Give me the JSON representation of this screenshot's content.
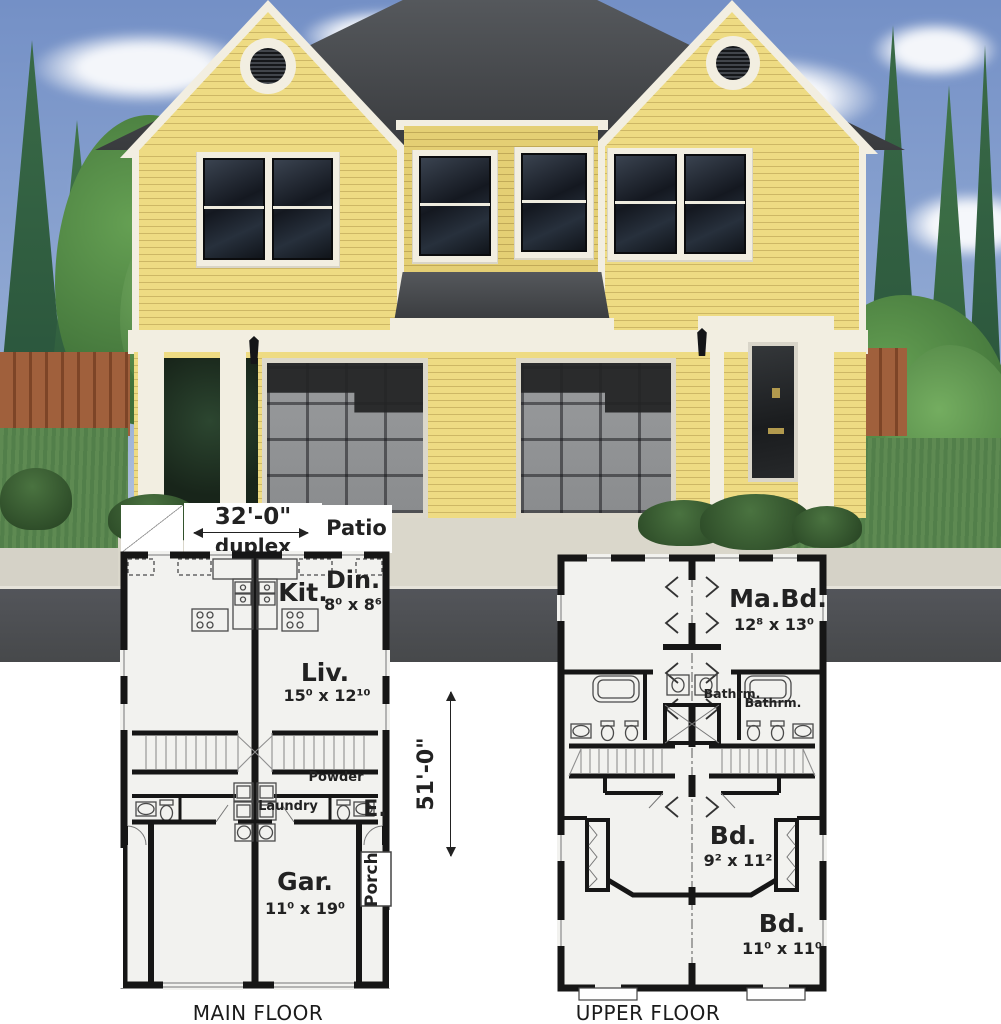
{
  "colors": {
    "sky": "#7490C6",
    "siding_yellow": "#ECD97F",
    "roof_gray": "#46484B",
    "trim_cream": "#F2EEE1",
    "garage_door_gray": "#8E9092",
    "road_gray": "#4E5052",
    "lawn_green": "#5E8A52",
    "plan_wall_black": "#161616",
    "plan_background": "#F2F2EF"
  },
  "main_floor": {
    "caption": "MAIN FLOOR",
    "width_dim": "32'-0\"",
    "width_label": "duplex",
    "depth_dim": "51'-0\"",
    "patio_label": "Patio",
    "rooms": {
      "dining": {
        "name": "Din.",
        "dims": "8⁰ x 8⁶"
      },
      "kitchen": {
        "name": "Kit."
      },
      "living": {
        "name": "Liv.",
        "dims": "15⁰ x 12¹⁰"
      },
      "powder": {
        "name": "Powder"
      },
      "laundry": {
        "name": "Laundry"
      },
      "entry": {
        "name": "E."
      },
      "porch": {
        "name": "Porch"
      },
      "garage": {
        "name": "Gar.",
        "dims": "11⁰ x 19⁰"
      }
    }
  },
  "upper_floor": {
    "caption": "UPPER FLOOR",
    "rooms": {
      "master_bedroom": {
        "name": "Ma.Bd.",
        "dims": "12⁸ x 13⁰"
      },
      "bathroom_1": {
        "name": "Bathrm."
      },
      "bathroom_2": {
        "name": "Bathrm."
      },
      "bedroom_2": {
        "name": "Bd.",
        "dims": "9² x 11²"
      },
      "bedroom_3": {
        "name": "Bd.",
        "dims": "11⁰ x 11⁰"
      }
    }
  }
}
